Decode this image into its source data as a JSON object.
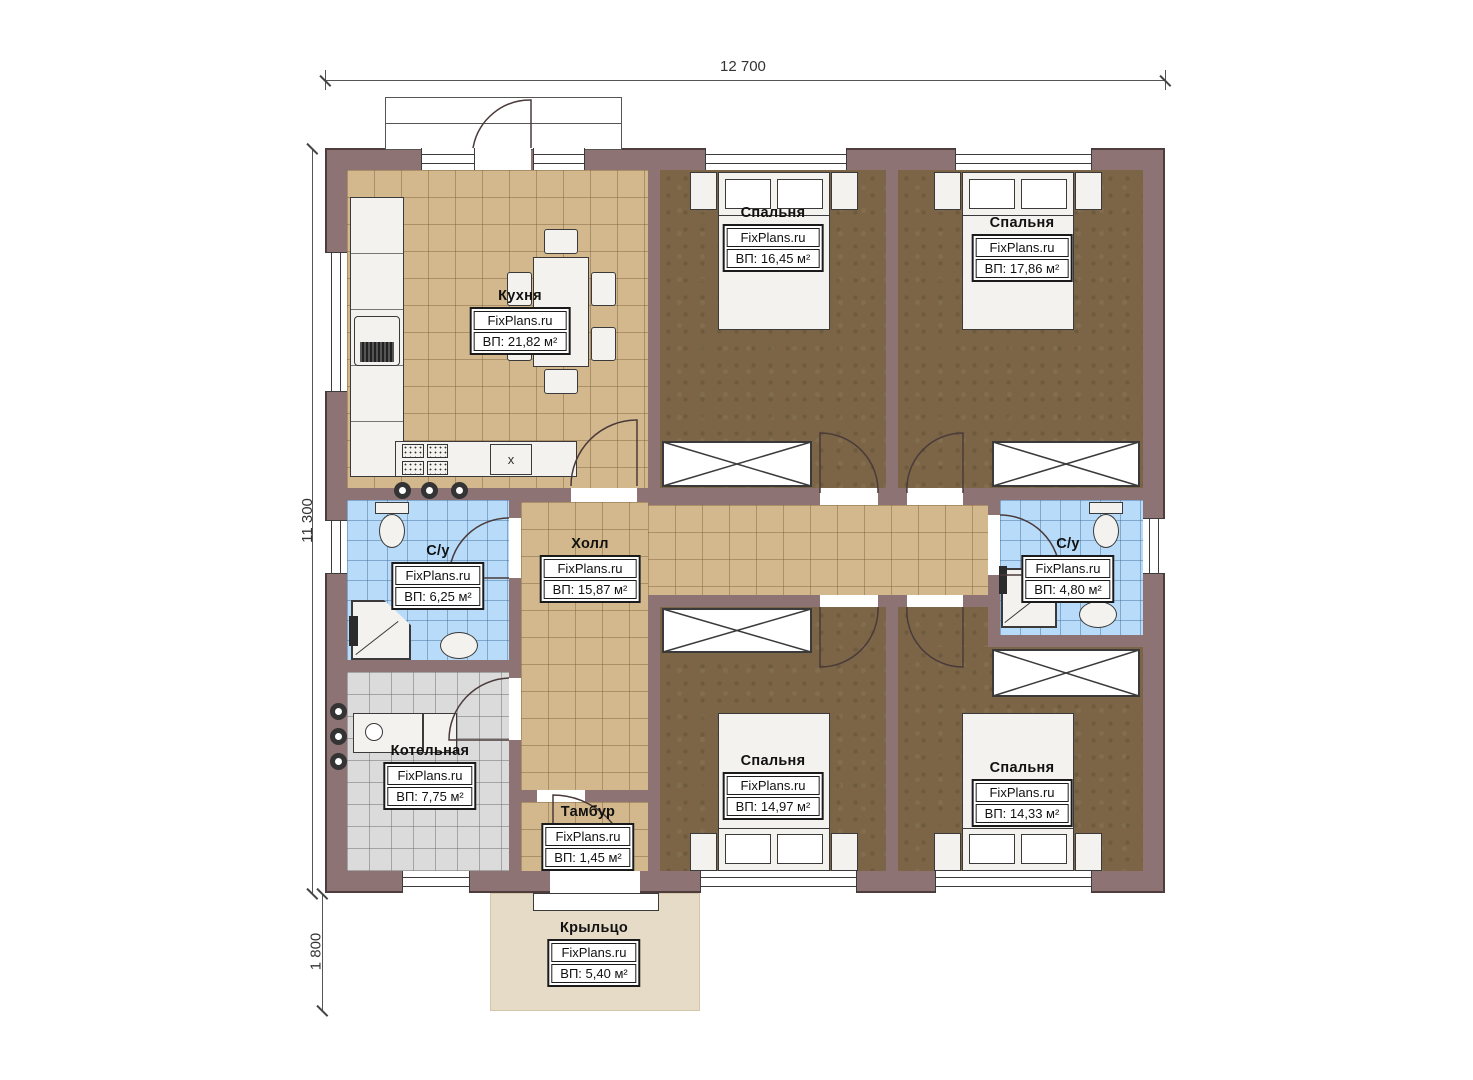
{
  "brand": "FixPlans.ru",
  "dims": {
    "width_top": "12 700",
    "height_left": "11 300",
    "porch_height": "1 800"
  },
  "rooms": {
    "kitchen": {
      "name": "Кухня",
      "area": "ВП: 21,82 м²"
    },
    "bedroom_top_left": {
      "name": "Спальня",
      "area": "ВП: 16,45 м²"
    },
    "bedroom_top_right": {
      "name": "Спальня",
      "area": "ВП: 17,86 м²"
    },
    "bathroom_left": {
      "name": "С/у",
      "area": "ВП: 6,25 м²"
    },
    "hall": {
      "name": "Холл",
      "area": "ВП: 15,87 м²"
    },
    "bathroom_right": {
      "name": "С/у",
      "area": "ВП: 4,80 м²"
    },
    "boiler_room": {
      "name": "Котельная",
      "area": "ВП: 7,75 м²"
    },
    "vestibule": {
      "name": "Тамбур",
      "area": "ВП: 1,45 м²"
    },
    "bedroom_bottom_left": {
      "name": "Спальня",
      "area": "ВП: 14,97 м²"
    },
    "bedroom_bottom_right": {
      "name": "Спальня",
      "area": "ВП: 14,33 м²"
    },
    "porch": {
      "name": "Крыльцо",
      "area": "ВП: 5,40 м²"
    }
  },
  "marks": {
    "appliance": "x"
  },
  "colors": {
    "wall": "#8d7373",
    "floor_beige": "#d3b88d",
    "floor_brown": "#7b6546",
    "floor_blue": "#b7dbf8",
    "floor_gray": "#dbdbdb",
    "porch": "#e6dbc6"
  }
}
